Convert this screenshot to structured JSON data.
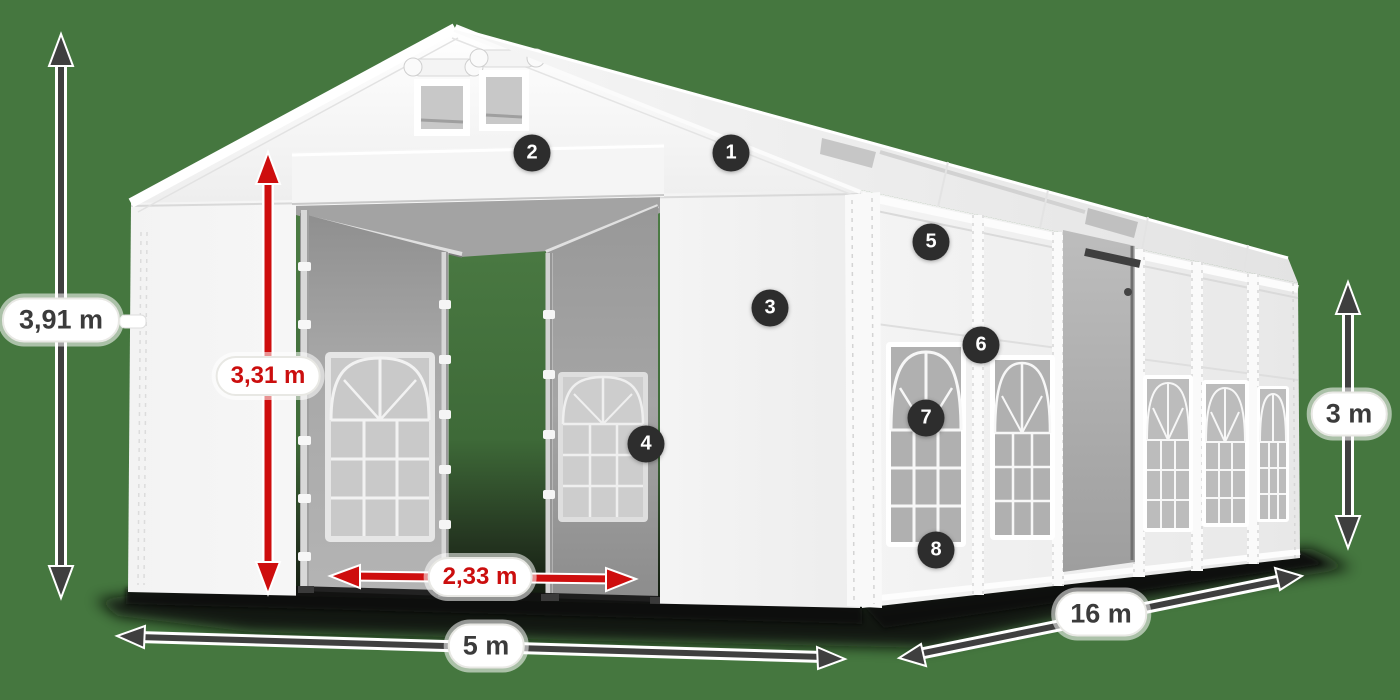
{
  "diagram": {
    "title": "Tent dimensions diagram",
    "dimensions": {
      "total_height": "3,91 m",
      "entrance_height": "3,31 m",
      "entrance_width": "2,33 m",
      "front_width": "5 m",
      "side_length": "16 m",
      "wall_height": "3 m"
    },
    "markers": [
      "1",
      "2",
      "3",
      "4",
      "5",
      "6",
      "7",
      "8"
    ],
    "colors": {
      "background_green": "#45773f",
      "arrow_gray": "#3f3f3f",
      "accent_red": "#cb0e0e",
      "badge_dark": "#2d2d2d",
      "tent_white": "#f5f5f5",
      "interior_gray": "#a3a3a3"
    }
  }
}
